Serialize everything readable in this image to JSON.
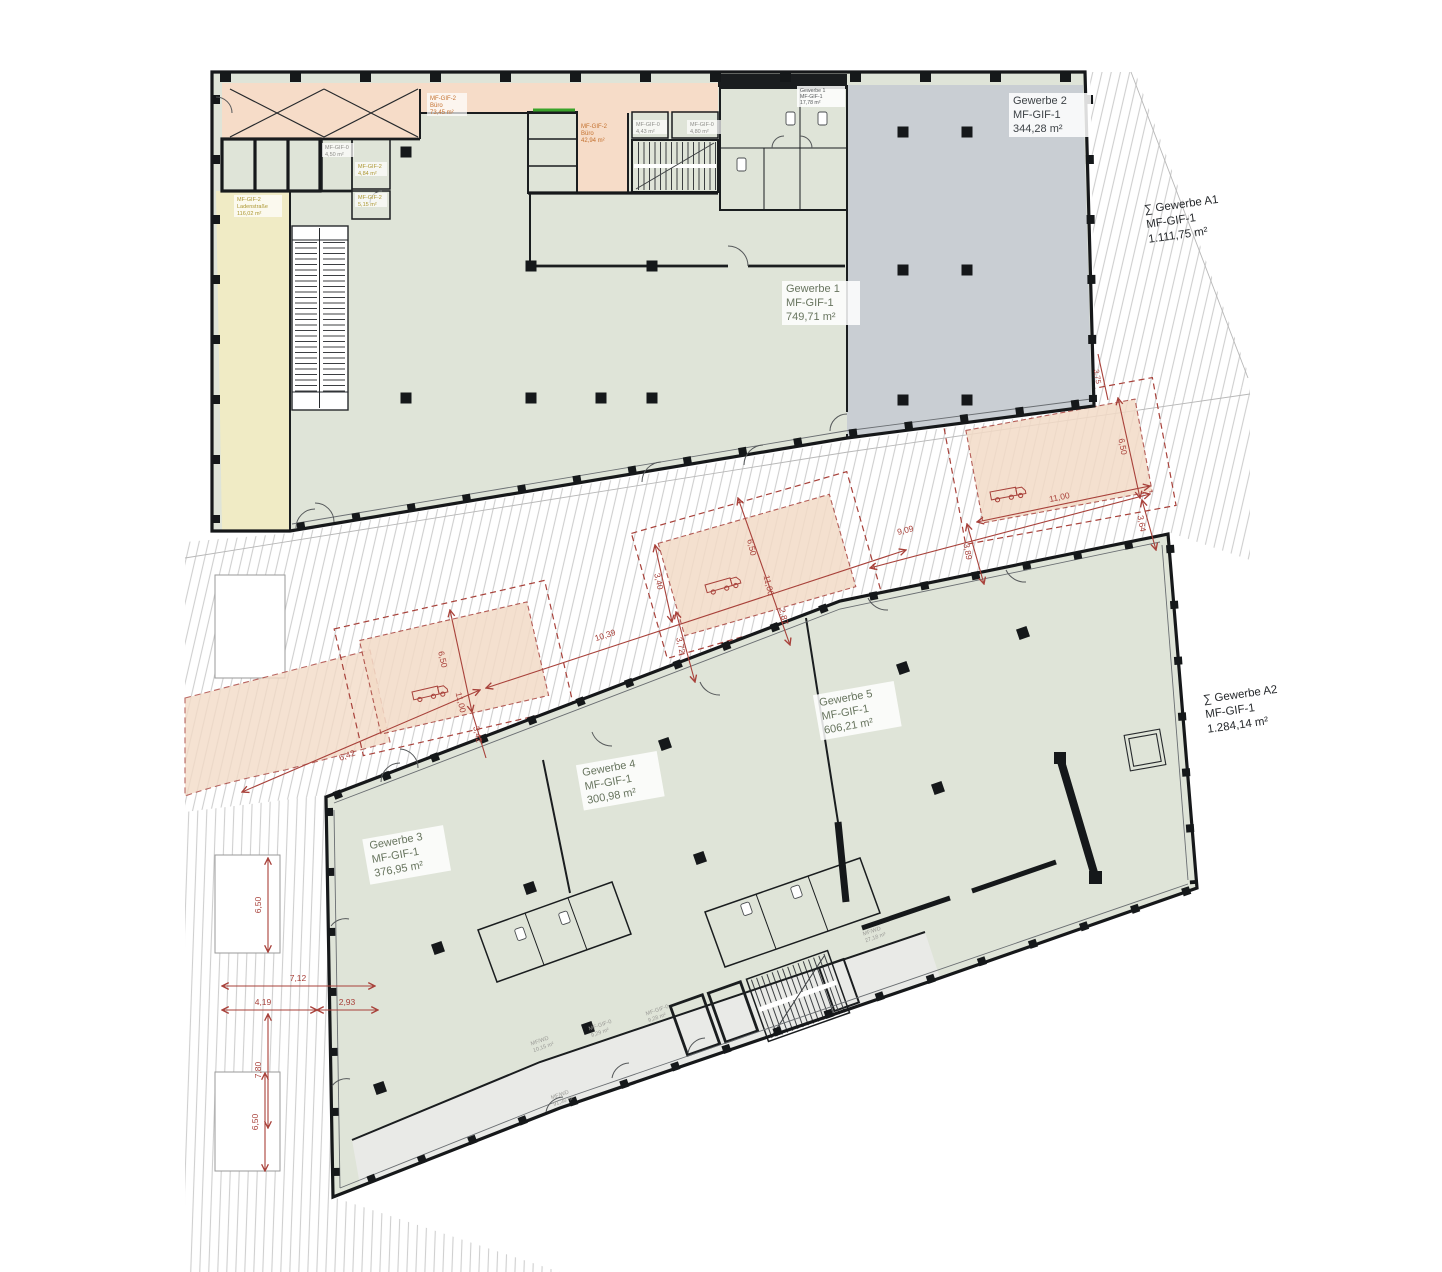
{
  "palette": {
    "wall": "#1a1d1f",
    "unit_green": "#dfe4d8",
    "unit_gray": "#c9ced3",
    "unit_peach": "#f6dcc8",
    "unit_yellow": "#f0ebc5",
    "corridor_gray": "#e9eae7",
    "dim_red": "#a8413a",
    "label_green": "#68755f",
    "label_orange": "#c4702e",
    "label_yellow": "#ac9732",
    "accent_green": "#3aa32a",
    "hatch_line": "#cfcfcf"
  },
  "labels": {
    "g1": {
      "name": "Gewerbe 1",
      "code": "MF-GIF-1",
      "area": "749,71 m²"
    },
    "g1wc": {
      "name": "Gewerbe 1",
      "code": "MF-GIF-1",
      "area": "17,78 m²"
    },
    "g2": {
      "name": "Gewerbe 2",
      "code": "MF-GIF-1",
      "area": "344,28 m²"
    },
    "g3": {
      "name": "Gewerbe 3",
      "code": "MF-GIF-1",
      "area": "376,95 m²"
    },
    "g4": {
      "name": "Gewerbe 4",
      "code": "MF-GIF-1",
      "area": "300,98 m²"
    },
    "g5": {
      "name": "Gewerbe 5",
      "code": "MF-GIF-1",
      "area": "606,21 m²"
    },
    "sumA1": {
      "name": "∑ Gewerbe A1",
      "code": "MF-GIF-1",
      "area": "1.111,75 m²"
    },
    "sumA2": {
      "name": "∑ Gewerbe A2",
      "code": "MF-GIF-1",
      "area": "1.284,14 m²"
    }
  },
  "rooms": {
    "buero73": {
      "code": "MF-GIF-2",
      "name": "Büro",
      "area": "73,45 m²"
    },
    "buero42": {
      "code": "MF-GIF-2",
      "name": "Büro",
      "area": "42,94 m²"
    },
    "r443": {
      "code": "MF-GIF-0",
      "area": "4,43 m²"
    },
    "r480": {
      "code": "MF-GIF-0",
      "area": "4,80 m²"
    },
    "r450": {
      "code": "MF-GIF-0",
      "area": "4,50 m²"
    },
    "r484": {
      "code": "MF-GIF-2",
      "area": "4,84 m²"
    },
    "r515": {
      "code": "MF-GIF-2",
      "area": "5,15 m²"
    },
    "laden": {
      "code": "MF-GIF-2",
      "name": "Ladenstraße",
      "area": "116,02 m²"
    },
    "c1015": {
      "code": "MF/WD",
      "area": "10,15 m²"
    },
    "c929": {
      "code": "MF-GIF-0",
      "area": "9,29 m²"
    },
    "c928": {
      "code": "MF-GIF-0",
      "area": "9,28 m²"
    },
    "c9135": {
      "code": "MF/WD",
      "area": "91,35 m²"
    },
    "c2718": {
      "code": "MF/WD",
      "area": "27,18 m²"
    }
  },
  "dims": {
    "d650": "6,50",
    "d1100": "11,00",
    "d375": "3,75",
    "d364": "3,64",
    "d389": "3,89",
    "d909": "9,09",
    "d287": "2,87",
    "d340": "3,40",
    "d372": "3,72",
    "d1039": "10,39",
    "d342": "3,42",
    "d642": "6,42",
    "d712": "7,12",
    "d419": "4,19",
    "d293": "2,93",
    "d780": "7,80"
  }
}
